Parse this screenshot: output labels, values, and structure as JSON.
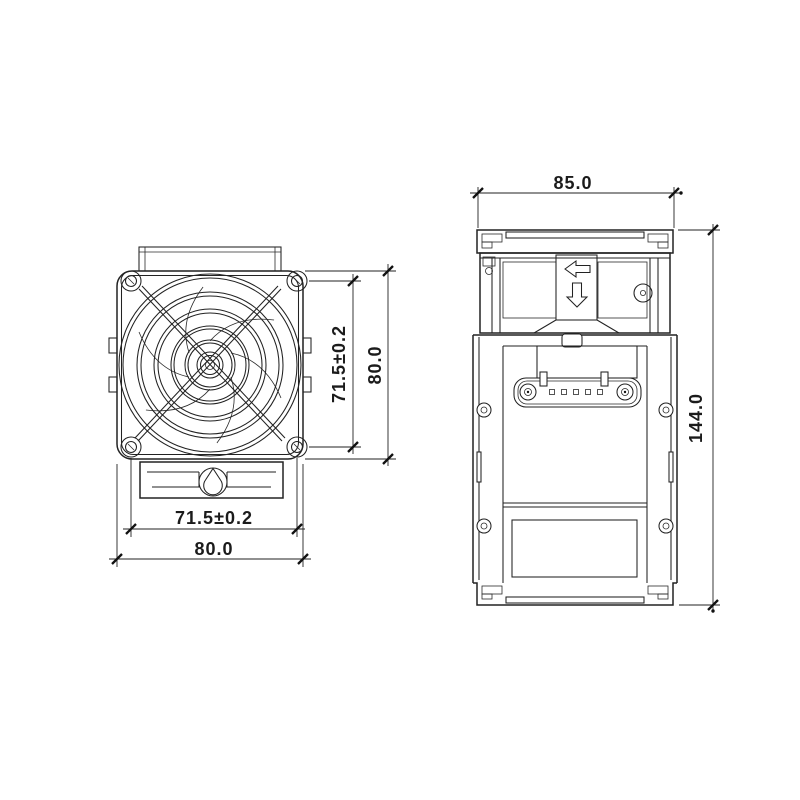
{
  "drawing": {
    "background": "#ffffff",
    "line_color": "#222222",
    "front_view": {
      "dim_hole_spacing_v": "71.5±0.2",
      "dim_outer_height": "80.0",
      "dim_hole_spacing_h": "71.5±0.2",
      "dim_outer_width": "80.0"
    },
    "side_view": {
      "dim_width": "85.0",
      "dim_height": "144.0"
    }
  }
}
